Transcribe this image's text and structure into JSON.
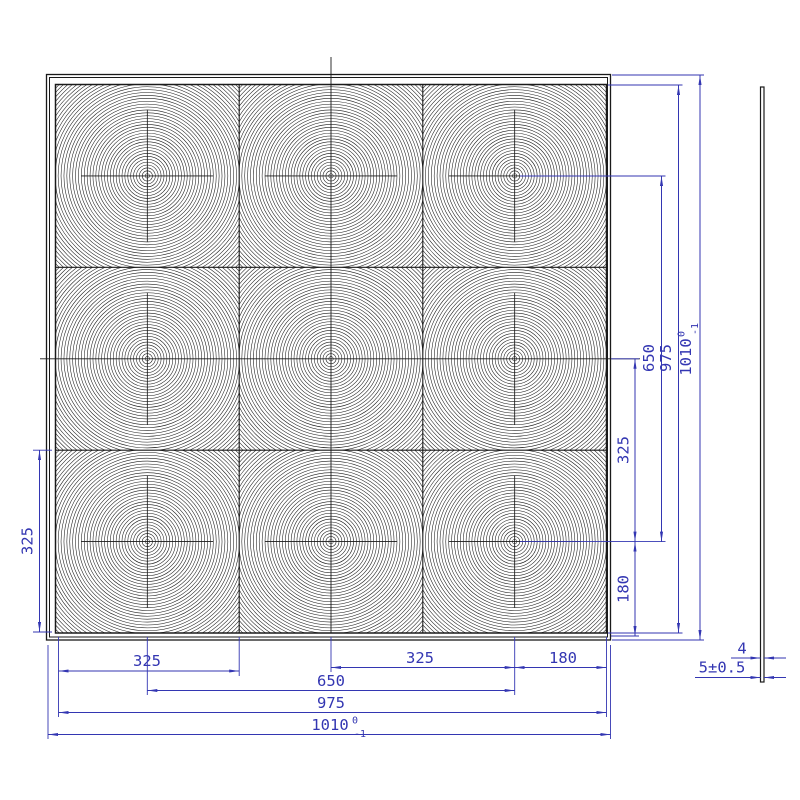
{
  "colors": {
    "dimension_blue": "#3336b2",
    "object_black": "#1a1a1a",
    "background": "#ffffff"
  },
  "front_view": {
    "description": "square panel with 3x3 array of concentric-ring lens cells",
    "lens_pattern": {
      "rows": 3,
      "cols": 3,
      "ring_count": 45,
      "ring_step": 2.9,
      "ring_start": 2.2,
      "crosshair_half": 66
    }
  },
  "side_view": {
    "description": "thin plate edge view"
  },
  "dimensions": {
    "bottom_325_left": "325",
    "bottom_325_right": "325",
    "bottom_180": "180",
    "bottom_650": "650",
    "bottom_975": "975",
    "bottom_1010": {
      "value": "1010",
      "sup": "0",
      "sub": "-1"
    },
    "right_325": "325",
    "right_180": "180",
    "right_650": "650",
    "right_975": "975",
    "right_1010": {
      "value": "1010",
      "sup": "0",
      "sub": "-1"
    },
    "left_325": "325",
    "side_thickness_4": "4",
    "side_thickness_5": "5±0.5"
  }
}
